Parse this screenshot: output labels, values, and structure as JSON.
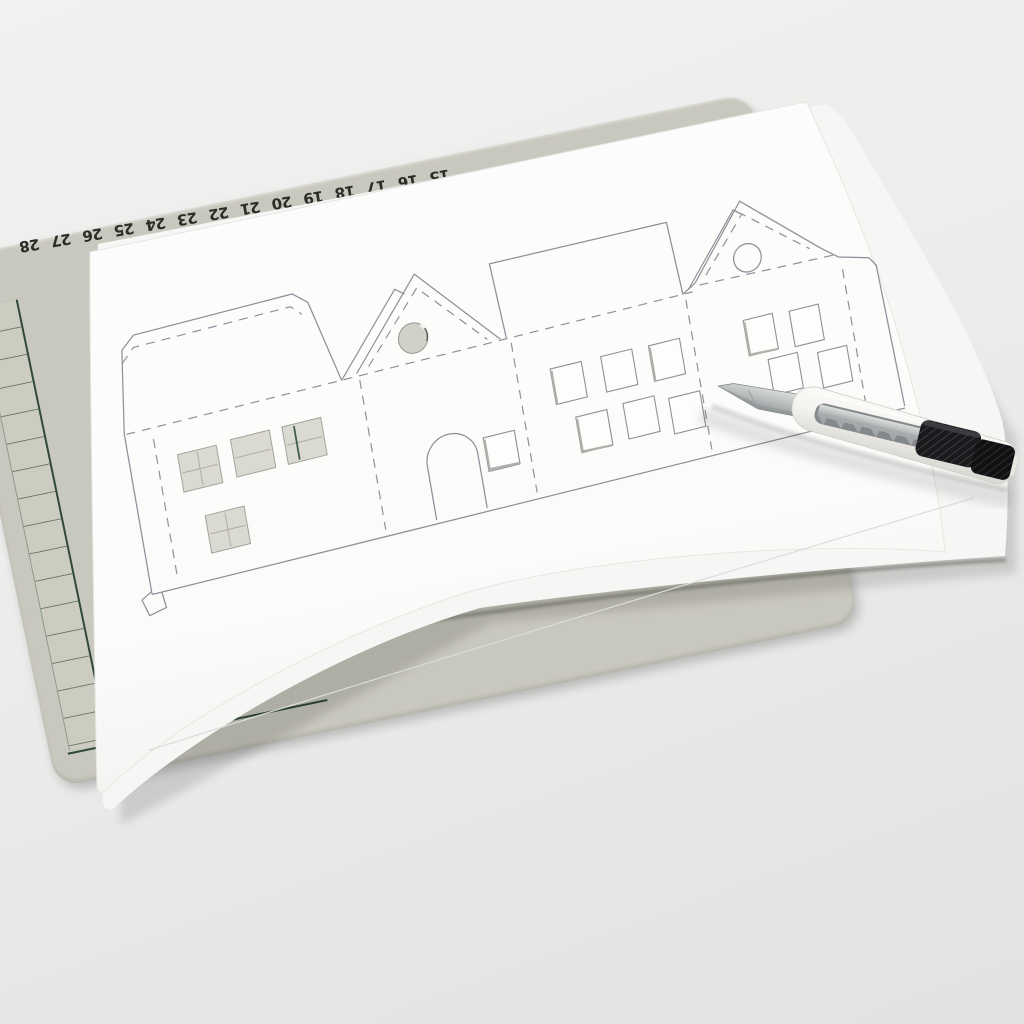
{
  "scene": {
    "description": "Photo of a paper house-village cutting template lying on a cutting mat with a snap-off craft knife",
    "objects": [
      "cutting-mat",
      "template-sheets",
      "house-template-drawing",
      "craft-knife"
    ],
    "table_color": "#ebebea"
  },
  "mat": {
    "surface_color": "#c9c8be",
    "grid_frame_color": "#30493b",
    "cell_line_color": "#72806f",
    "number_color": "#2b2b28",
    "corner_label": "022",
    "ruler_numbers": [
      "28",
      "27",
      "26",
      "25",
      "24",
      "23",
      "22",
      "21",
      "20",
      "19",
      "18",
      "17",
      "16",
      "15"
    ]
  },
  "paper": {
    "top_sheet_color": "#fcfcfb",
    "under_sheet_color": "#f6f6f4",
    "print_line_color": "#8f8f99",
    "fold_line_style": "dashed"
  },
  "template": {
    "houses": [
      {
        "id": "house-1",
        "type": "two-story house with top glue flap",
        "cut_windows": 4
      },
      {
        "id": "house-2",
        "type": "gable house with round cut window and arched door",
        "cut_windows": 2
      },
      {
        "id": "house-3",
        "type": "house with large roof flap",
        "cut_windows": 6
      },
      {
        "id": "house-4",
        "type": "gable house with drawn round window",
        "cut_windows": 4
      }
    ],
    "cutout_fill_color": "#d2d1c9"
  },
  "knife": {
    "type": "snap-off craft knife",
    "handle_color": "#f6f5f2",
    "slider_color": "#1a1a1c",
    "blade_color": "#b6babb"
  }
}
